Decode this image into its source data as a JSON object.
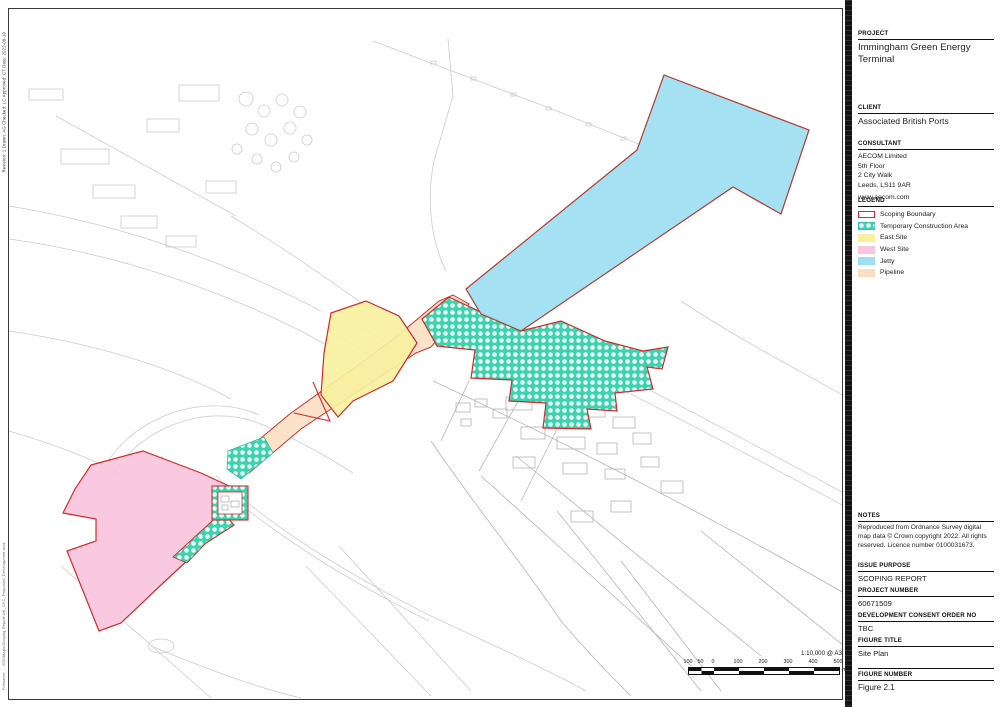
{
  "titleblock": {
    "project_label": "PROJECT",
    "project_title": "Immingham Green Energy Terminal",
    "client_label": "CLIENT",
    "client_name": "Associated British Ports",
    "consultant_label": "CONSULTANT",
    "consultant_address": [
      "AECOM Limited",
      "5th Floor",
      "2 City Walk",
      "Leeds, LS11 9AR",
      "www.aecom.com"
    ],
    "legend_label": "LEGEND",
    "legend_items": [
      {
        "label": "Scoping Boundary",
        "swatch": "scoping-boundary"
      },
      {
        "label": "Temporary Construction Area",
        "swatch": "temporary-construction-area"
      },
      {
        "label": "East Site",
        "swatch": "east-site"
      },
      {
        "label": "West Site",
        "swatch": "west-site"
      },
      {
        "label": "Jetty",
        "swatch": "jetty"
      },
      {
        "label": "Pipeline",
        "swatch": "pipeline"
      }
    ],
    "notes_label": "NOTES",
    "notes_text": "Reproduced from Ordnance Survey digital map data © Crown copyright 2022. All rights reserved. Licence number 0100031673.",
    "issue_purpose_label": "ISSUE PURPOSE",
    "issue_purpose_value": "SCOPING REPORT",
    "project_number_label": "PROJECT NUMBER",
    "project_number_value": "60671509",
    "dco_label": "DEVELOPMENT CONSENT ORDER NO",
    "dco_value": "TBC",
    "figure_title_label": "FIGURE TITLE",
    "figure_title_value": "Site Plan",
    "figure_number_label": "FIGURE NUMBER",
    "figure_number_value": "Figure 2.1"
  },
  "map": {
    "scale_text": "1:10,000 @ A3",
    "scale_ticks": [
      "100",
      "50",
      "0",
      "100",
      "200",
      "300",
      "400",
      "500"
    ],
    "scale_unit": "m",
    "colors": {
      "scoping_boundary": "#d42a2a",
      "temporary_construction_area": "#3ed2ae",
      "east_site": "#f6f1a0",
      "west_site": "#f9c6dc",
      "jetty": "#9fdff2",
      "pipeline": "#f9e0c2",
      "linework": "#c8c8c8",
      "village_linework": "#b5b5b5"
    }
  },
  "marginalia": {
    "revision_line": "Revision: 1    Drawn: AG    Checked: LC    Approved: CT    Date: 2022-09-19",
    "filename_line": "Filename: ...\\GIS\\Maps\\Scoping Report\\UK_CHC_Proposed_Development.mxd"
  }
}
